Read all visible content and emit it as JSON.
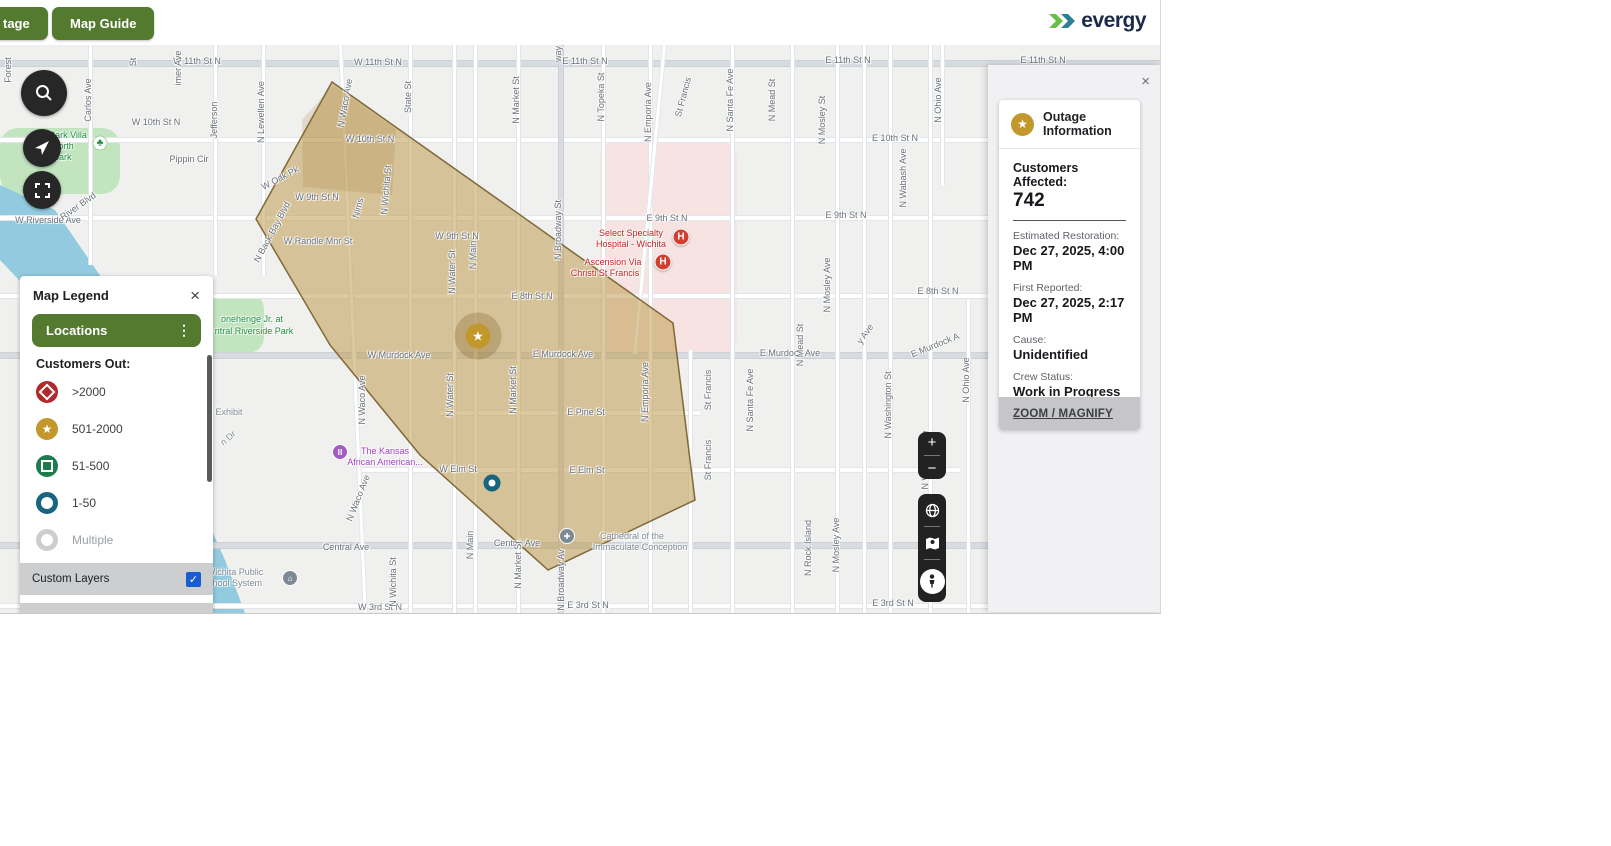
{
  "topbar": {
    "partial_label": "tage",
    "map_guide_label": "Map Guide",
    "brand": "evergy"
  },
  "colors": {
    "button_green": "#537a2f",
    "brand_navy": "#1b2a49",
    "checkbox_blue": "#1a5dd1",
    "outage_polygon_tan": "#bd984a",
    "marker_gold": "#c2982c",
    "marker_teal": "#17657f",
    "marker_red": "#d23f31",
    "legend_red": "#b3282d",
    "legend_green": "#1e7b4f"
  },
  "legend": {
    "title": "Map Legend",
    "close": "×",
    "locations_label": "Locations",
    "customers_out_label": "Customers Out:",
    "items": [
      {
        "icon": "diamond",
        "color": "#b3282d",
        "label": ">2000",
        "muted": false
      },
      {
        "icon": "star",
        "color": "#c2982c",
        "label": "501-2000",
        "muted": false
      },
      {
        "icon": "square",
        "color": "#1e7b4f",
        "label": "51-500",
        "muted": false
      },
      {
        "icon": "ring",
        "color": "#17657f",
        "label": "1-50",
        "muted": false
      },
      {
        "icon": "ring",
        "color": "#cdcdcd",
        "label": "Multiple",
        "muted": true
      }
    ],
    "custom_layers_label": "Custom Layers",
    "service_area_label": "Service Area",
    "checkbox_glyph": "✓"
  },
  "panel": {
    "close": "×",
    "title": "Outage Information",
    "customers_label": "Customers Affected:",
    "customers_value": "742",
    "fields": [
      {
        "label": "Estimated Restoration:",
        "value": "Dec 27, 2025, 4:00 PM"
      },
      {
        "label": "First Reported:",
        "value": "Dec 27, 2025, 2:17 PM"
      },
      {
        "label": "Cause:",
        "value": "Unidentified"
      },
      {
        "label": "Crew Status:",
        "value": "Work in Progress"
      }
    ],
    "zoom_link": "ZOOM / MAGNIFY"
  },
  "controls": {
    "zoom_in": "+",
    "zoom_out": "−"
  },
  "map": {
    "labels": [
      {
        "t": "W 11th St N",
        "x": 197,
        "y": 16
      },
      {
        "t": "W 11th St N",
        "x": 378,
        "y": 17
      },
      {
        "t": "E 11th St N",
        "x": 585,
        "y": 16
      },
      {
        "t": "E 11th St N",
        "x": 848,
        "y": 15
      },
      {
        "t": "E 11th St N",
        "x": 1043,
        "y": 15
      },
      {
        "t": "W 10th St N",
        "x": 156,
        "y": 77
      },
      {
        "t": "W 10th St N",
        "x": 370,
        "y": 94
      },
      {
        "t": "E 10th St N",
        "x": 895,
        "y": 93
      },
      {
        "t": "Pippin Cir",
        "x": 189,
        "y": 114
      },
      {
        "t": "W 9th St N",
        "x": 317,
        "y": 152
      },
      {
        "t": "W 9th St N",
        "x": 457,
        "y": 191
      },
      {
        "t": "E 9th St N",
        "x": 667,
        "y": 173
      },
      {
        "t": "E 9th St N",
        "x": 846,
        "y": 170
      },
      {
        "t": "W Randle Mnr St",
        "x": 318,
        "y": 196
      },
      {
        "t": "E 8th St N",
        "x": 532,
        "y": 251
      },
      {
        "t": "E 8th St N",
        "x": 938,
        "y": 246
      },
      {
        "t": "W Murdock Ave",
        "x": 399,
        "y": 310
      },
      {
        "t": "E Murdock Ave",
        "x": 563,
        "y": 309
      },
      {
        "t": "E Murdock Ave",
        "x": 790,
        "y": 308
      },
      {
        "t": "E Pine St",
        "x": 586,
        "y": 367
      },
      {
        "t": "W Elm St",
        "x": 458,
        "y": 424
      },
      {
        "t": "E Elm St",
        "x": 587,
        "y": 425
      },
      {
        "t": "Central Ave",
        "x": 346,
        "y": 502
      },
      {
        "t": "Central Ave",
        "x": 517,
        "y": 498
      },
      {
        "t": "W 3rd St N",
        "x": 380,
        "y": 562
      },
      {
        "t": "E 3rd St N",
        "x": 588,
        "y": 560
      },
      {
        "t": "E 3rd St N",
        "x": 893,
        "y": 558
      },
      {
        "t": "W Riverside Ave",
        "x": 48,
        "y": 175
      },
      {
        "t": "W Oak Pk",
        "x": 280,
        "y": 133,
        "r": -28
      },
      {
        "t": "N Back Bay Blvd",
        "x": 272,
        "y": 187,
        "r": -62
      },
      {
        "t": "River Blvd",
        "x": 78,
        "y": 161,
        "r": -35
      },
      {
        "t": "Nims",
        "x": 358,
        "y": 163,
        "r": -75
      },
      {
        "t": "E Murdock A",
        "x": 935,
        "y": 300,
        "r": -22
      },
      {
        "t": "y Ave",
        "x": 865,
        "y": 289,
        "r": -55
      },
      {
        "t": "Forest",
        "x": 8,
        "y": 25,
        "r": -90
      },
      {
        "t": "Carlos Ave",
        "x": 88,
        "y": 55,
        "r": -90
      },
      {
        "t": "imer Ave",
        "x": 178,
        "y": 23,
        "r": -90
      },
      {
        "t": "St",
        "x": 133,
        "y": 17,
        "r": -90
      },
      {
        "t": "Jefferson",
        "x": 214,
        "y": 75,
        "r": -90
      },
      {
        "t": "N Lewellen Ave",
        "x": 261,
        "y": 67,
        "r": -90
      },
      {
        "t": "State St",
        "x": 408,
        "y": 52,
        "r": -90
      },
      {
        "t": "N Waco Ave",
        "x": 345,
        "y": 58,
        "r": -80
      },
      {
        "t": "N Waco Ave",
        "x": 362,
        "y": 355,
        "r": -90
      },
      {
        "t": "N Waco Ave",
        "x": 358,
        "y": 453,
        "r": -68
      },
      {
        "t": "N Wichita St",
        "x": 386,
        "y": 145,
        "r": -85
      },
      {
        "t": "N Wichita St",
        "x": 393,
        "y": 537,
        "r": -90
      },
      {
        "t": "N Water St",
        "x": 452,
        "y": 227,
        "r": -90
      },
      {
        "t": "N Water St",
        "x": 450,
        "y": 350,
        "r": -90
      },
      {
        "t": "N Main",
        "x": 473,
        "y": 210,
        "r": -90
      },
      {
        "t": "N Main",
        "x": 470,
        "y": 500,
        "r": -90
      },
      {
        "t": "N Market St",
        "x": 516,
        "y": 55,
        "r": -90
      },
      {
        "t": "N Market St",
        "x": 513,
        "y": 345,
        "r": -90
      },
      {
        "t": "N Market St",
        "x": 518,
        "y": 520,
        "r": -90
      },
      {
        "t": "way",
        "x": 558,
        "y": 9,
        "r": -90
      },
      {
        "t": "N Broadway St",
        "x": 558,
        "y": 185,
        "r": -90
      },
      {
        "t": "N Broadway Av",
        "x": 561,
        "y": 535,
        "r": -90
      },
      {
        "t": "N Topeka St",
        "x": 601,
        "y": 52,
        "r": -90
      },
      {
        "t": "N Emporia Ave",
        "x": 648,
        "y": 67,
        "r": -90
      },
      {
        "t": "N Emporia Ave",
        "x": 645,
        "y": 347,
        "r": -90
      },
      {
        "t": "St Francis",
        "x": 683,
        "y": 52,
        "r": -75
      },
      {
        "t": "St Francis",
        "x": 708,
        "y": 345,
        "r": -90
      },
      {
        "t": "St Francis",
        "x": 708,
        "y": 415,
        "r": -90
      },
      {
        "t": "N Santa Fe Ave",
        "x": 730,
        "y": 55,
        "r": -90
      },
      {
        "t": "N Santa Fe Ave",
        "x": 750,
        "y": 355,
        "r": -90
      },
      {
        "t": "N Mead St",
        "x": 772,
        "y": 55,
        "r": -90
      },
      {
        "t": "N Mead St",
        "x": 800,
        "y": 300,
        "r": -90
      },
      {
        "t": "N Mosley St",
        "x": 822,
        "y": 75,
        "r": -90
      },
      {
        "t": "N Mosley Ave",
        "x": 827,
        "y": 240,
        "r": -90
      },
      {
        "t": "N Mosley Ave",
        "x": 836,
        "y": 500,
        "r": -90
      },
      {
        "t": "N Washington St",
        "x": 888,
        "y": 360,
        "r": -90
      },
      {
        "t": "N Rock Island",
        "x": 808,
        "y": 503,
        "r": -90
      },
      {
        "t": "N Wabash Ave",
        "x": 903,
        "y": 133,
        "r": -90
      },
      {
        "t": "N Wabash Ave",
        "x": 925,
        "y": 415,
        "r": -90
      },
      {
        "t": "N Ohio Ave",
        "x": 938,
        "y": 55,
        "r": -90
      },
      {
        "t": "N Ohio Ave",
        "x": 966,
        "y": 335,
        "r": -90
      },
      {
        "t": "Park Villa",
        "x": 68,
        "y": 90,
        "cls": "green"
      },
      {
        "t": "- North",
        "x": 60,
        "y": 101,
        "cls": "green"
      },
      {
        "t": "le park",
        "x": 58,
        "y": 112,
        "cls": "green"
      },
      {
        "t": "onehenge Jr. at",
        "x": 252,
        "y": 274,
        "cls": "green"
      },
      {
        "t": "ntral Riverside Park",
        "x": 254,
        "y": 286,
        "cls": "green"
      },
      {
        "t": "fe Exhibit",
        "x": 224,
        "y": 367,
        "cls": "grey"
      },
      {
        "t": "n Dr",
        "x": 228,
        "y": 393,
        "r": -40,
        "cls": "grey"
      },
      {
        "t": "The Kansas",
        "x": 385,
        "y": 406,
        "cls": "purple"
      },
      {
        "t": "African American...",
        "x": 385,
        "y": 417,
        "cls": "purple"
      },
      {
        "t": "Select Specialty",
        "x": 631,
        "y": 188,
        "cls": "red"
      },
      {
        "t": "Hospital - Wichita",
        "x": 631,
        "y": 199,
        "cls": "red"
      },
      {
        "t": "Ascension Via",
        "x": 613,
        "y": 217,
        "cls": "red"
      },
      {
        "t": "Christi St Francis",
        "x": 605,
        "y": 228,
        "cls": "red"
      },
      {
        "t": "Cathedral of the",
        "x": 632,
        "y": 491,
        "cls": "grey"
      },
      {
        "t": "Immaculate Conception",
        "x": 640,
        "y": 502,
        "cls": "grey"
      },
      {
        "t": "Wichita Public",
        "x": 235,
        "y": 527,
        "cls": "grey"
      },
      {
        "t": "School System",
        "x": 232,
        "y": 538,
        "cls": "grey"
      }
    ],
    "markers": [
      {
        "type": "star",
        "x": 478,
        "y": 291,
        "name": "outage-star-marker-501-2000"
      },
      {
        "type": "ring",
        "x": 492,
        "y": 438,
        "name": "outage-circle-marker-1-50"
      },
      {
        "type": "hospital",
        "x": 681,
        "y": 192,
        "name": "hospital-marker"
      },
      {
        "type": "hospital",
        "x": 663,
        "y": 217,
        "name": "hospital-marker"
      },
      {
        "type": "museum",
        "x": 340,
        "y": 407,
        "name": "museum-marker"
      },
      {
        "type": "cathedral",
        "x": 567,
        "y": 491,
        "name": "cathedral-marker"
      },
      {
        "type": "school",
        "x": 290,
        "y": 533,
        "name": "school-marker"
      },
      {
        "type": "tree",
        "x": 100,
        "y": 98,
        "name": "park-marker"
      }
    ],
    "marker_glyphs": {
      "star": "★",
      "ring": "",
      "hospital": "H",
      "museum": "Ⅲ",
      "cathedral": "✚",
      "school": "⌂",
      "tree": "♣"
    }
  }
}
